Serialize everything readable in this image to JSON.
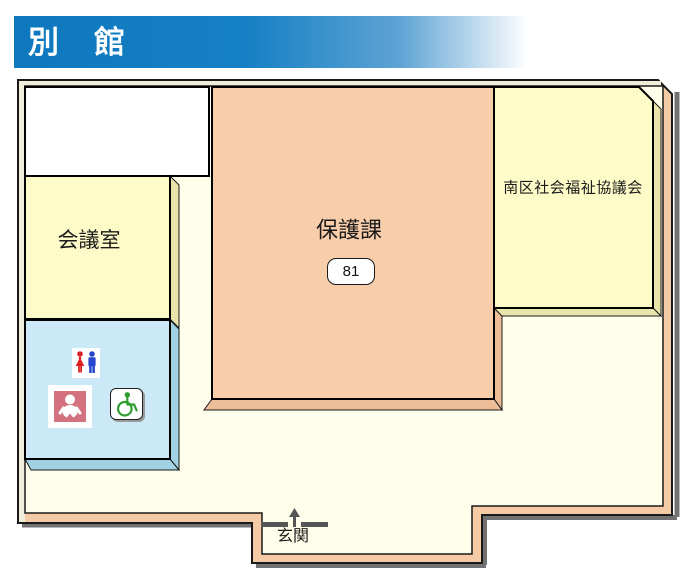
{
  "header": {
    "title": "別　館",
    "bar_color": "#0e78be"
  },
  "rooms": {
    "meeting": {
      "label": "会議室"
    },
    "hogoka": {
      "label": "保護課",
      "extension": "81"
    },
    "council": {
      "label": "南区社会福祉協議会"
    },
    "entrance": {
      "label": "玄関"
    }
  },
  "icons": {
    "restroom": "male-female-restroom-icon",
    "baby": "baby-care-room-icon",
    "wheelchair": "wheelchair-accessible-icon",
    "entrance_arrow": "up-arrow-icon"
  },
  "colors": {
    "floor": "#fffeea",
    "wall_shaded": "#f5cba5",
    "wall_lit": "#efeedb",
    "room_yellow": "#fdfbc8",
    "room_orange": "#f8cdaa",
    "room_white": "#ffffff",
    "restroom_blue": "#cce9f8",
    "shadow": "#727272",
    "female_red": "#dd2020",
    "male_blue": "#2545cc",
    "baby_rose": "#d4717f",
    "wheelchair_green": "#2f9e2f"
  }
}
